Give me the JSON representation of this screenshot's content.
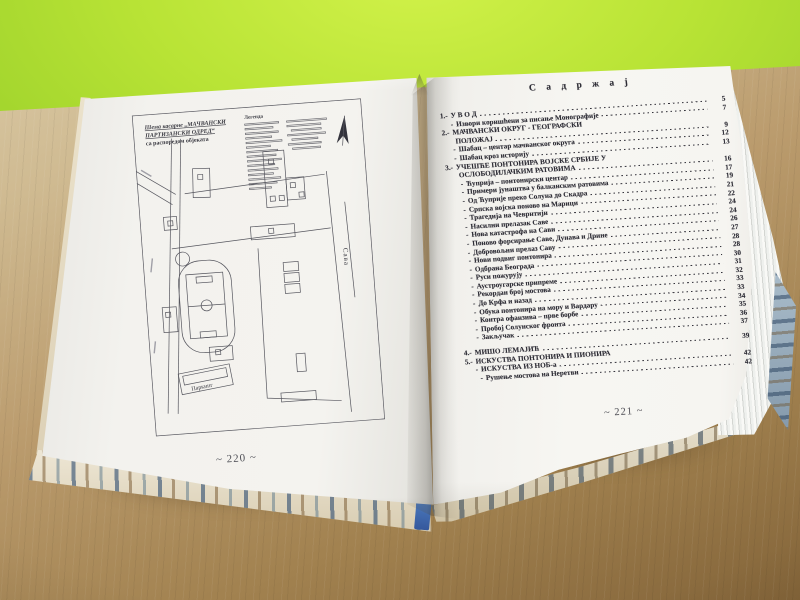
{
  "colors": {
    "wall_green": "#a9d92f",
    "desk_wood": "#b2925f",
    "page_white": "#f4f3ef",
    "ink": "#2e2d36",
    "cover_notch_blue": "#3f6db3"
  },
  "book": {
    "left_page": {
      "page_number": "~ 220 ~",
      "map": {
        "title_line1": "Шема касарне „МАЧВАНСКИ",
        "title_line2": "ПАРТИЗАНСКИ ОДРЕД“",
        "title_line3": "са распоредом објеката",
        "legend_title": "Легенда",
        "river_label": "Сава",
        "parking_label": "Паркинг"
      }
    },
    "right_page": {
      "page_number": "~ 221 ~",
      "toc_title": "С а д р ж а ј",
      "entries": [
        {
          "prefix": "1.-",
          "label": "У В О Д",
          "page": "5"
        },
        {
          "prefix": "-",
          "label": "Извори коришћени за писање Монографије",
          "page": "7",
          "indent": 1
        },
        {
          "prefix": "2.-",
          "label": "МАЧВАНСКИ ОКРУГ - ГЕОГРАФСКИ",
          "page": ""
        },
        {
          "prefix": "",
          "label": "ПОЛОЖАЈ",
          "page": "9",
          "indent": 1
        },
        {
          "prefix": "-",
          "label": "Шабац – центар мачванског округа",
          "page": "12",
          "indent": 1
        },
        {
          "prefix": "-",
          "label": "Шабац кроз историју",
          "page": "13",
          "indent": 1
        },
        {
          "prefix": "3.-",
          "label": "УЧЕШЋЕ ПОНТОНИРА ВОЈСКЕ СРБИЈЕ У",
          "page": ""
        },
        {
          "prefix": "",
          "label": "ОСЛОБОДИЛАЧКИМ РАТОВИМА",
          "page": "16",
          "indent": 1
        },
        {
          "prefix": "-",
          "label": "Ћуприја – понтонирски центар",
          "page": "17",
          "indent": 2
        },
        {
          "prefix": "-",
          "label": "Примери јунаштва у балканским ратовима",
          "page": "19",
          "indent": 2
        },
        {
          "prefix": "-",
          "label": "Од Ћуприје преко Солуна до Скадра",
          "page": "21",
          "indent": 2
        },
        {
          "prefix": "-",
          "label": "Српска војска поново на Марици",
          "page": "22",
          "indent": 2
        },
        {
          "prefix": "-",
          "label": "Трагедија на Чеврнтији",
          "page": "24",
          "indent": 2
        },
        {
          "prefix": "-",
          "label": "Насилни прелазак Саве",
          "page": "24",
          "indent": 2
        },
        {
          "prefix": "-",
          "label": "Нова катастрофа на Сави",
          "page": "26",
          "indent": 2
        },
        {
          "prefix": "-",
          "label": "Поново форсирање Саве, Дунава и Дрине",
          "page": "27",
          "indent": 2
        },
        {
          "prefix": "-",
          "label": "Добровољни прелаз Саву",
          "page": "28",
          "indent": 2
        },
        {
          "prefix": "-",
          "label": "Нови подвиг понтонира",
          "page": "28",
          "indent": 2
        },
        {
          "prefix": "-",
          "label": "Одбрана Београда",
          "page": "30",
          "indent": 2
        },
        {
          "prefix": "-",
          "label": "Руси пожурују",
          "page": "31",
          "indent": 2
        },
        {
          "prefix": "-",
          "label": "Аустроугарске припреме",
          "page": "32",
          "indent": 2
        },
        {
          "prefix": "-",
          "label": "Рекордан број мостова",
          "page": "33",
          "indent": 2
        },
        {
          "prefix": "-",
          "label": "До Крфа и назад",
          "page": "33",
          "indent": 2
        },
        {
          "prefix": "-",
          "label": "Обука понтонира на мору и Вардару",
          "page": "34",
          "indent": 2
        },
        {
          "prefix": "-",
          "label": "Контра офанзива – прве борбе",
          "page": "35",
          "indent": 2
        },
        {
          "prefix": "-",
          "label": "Пробој Солунског фронта",
          "page": "36",
          "indent": 2
        },
        {
          "prefix": "-",
          "label": "Закључак",
          "page": "37",
          "indent": 2
        },
        {
          "prefix": "4.-",
          "label": "МИШО ЛЕМАЈИЋ",
          "page": "39",
          "gap": true
        },
        {
          "prefix": "5.-",
          "label": "ИСКУСТВА ПОНТОНИРА И ПИОНИРА",
          "page": ""
        },
        {
          "prefix": "-",
          "label": "ИСКУСТВА ИЗ НОБ-а",
          "page": "42",
          "indent": 1
        },
        {
          "prefix": "-",
          "label": "Рушење мостова на Неретви",
          "page": "42",
          "indent": 2
        }
      ]
    }
  }
}
